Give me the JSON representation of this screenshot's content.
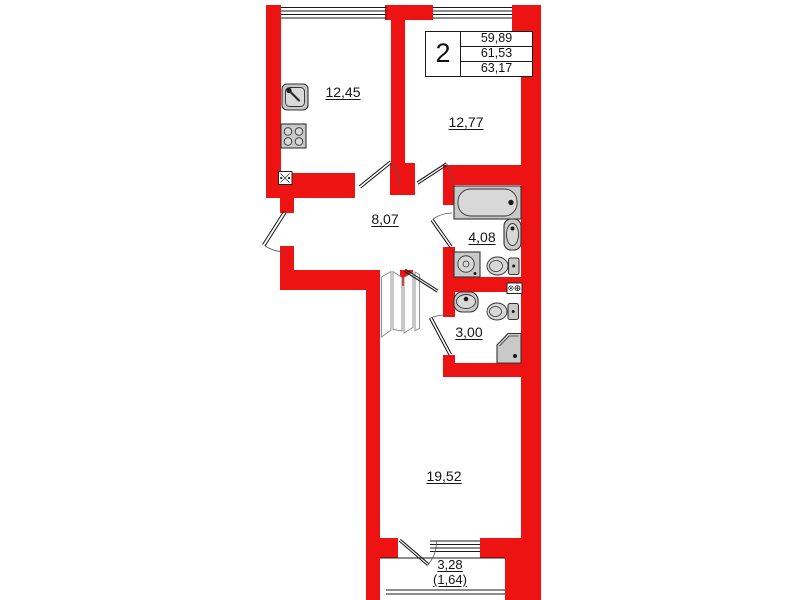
{
  "title_block": {
    "rooms_count": "2",
    "values": [
      "59,89",
      "61,53",
      "63,17"
    ]
  },
  "rooms": [
    {
      "id": "kitchen",
      "area": "12,45"
    },
    {
      "id": "room",
      "area": "12,77"
    },
    {
      "id": "hallway",
      "area": "8,07"
    },
    {
      "id": "bathroom",
      "area": "4,08"
    },
    {
      "id": "wc",
      "area": "3,00"
    },
    {
      "id": "living-room",
      "area": "19,52"
    },
    {
      "id": "balcony",
      "area": "3,28",
      "area_reduced": "(1,64)"
    }
  ],
  "fixtures": [
    "kitchen-sink",
    "stove",
    "ventilation-shaft",
    "bathtub",
    "washbasin",
    "washing-machine",
    "toilet",
    "ventilation-shaft",
    "washbasin",
    "toilet",
    "shower-cabin"
  ],
  "colors": {
    "wall": "#ee1313",
    "fixture_fill": "#c9c9c9",
    "fixture_stroke": "#333333",
    "line": "#1a1a1a",
    "background": "#ffffff"
  }
}
